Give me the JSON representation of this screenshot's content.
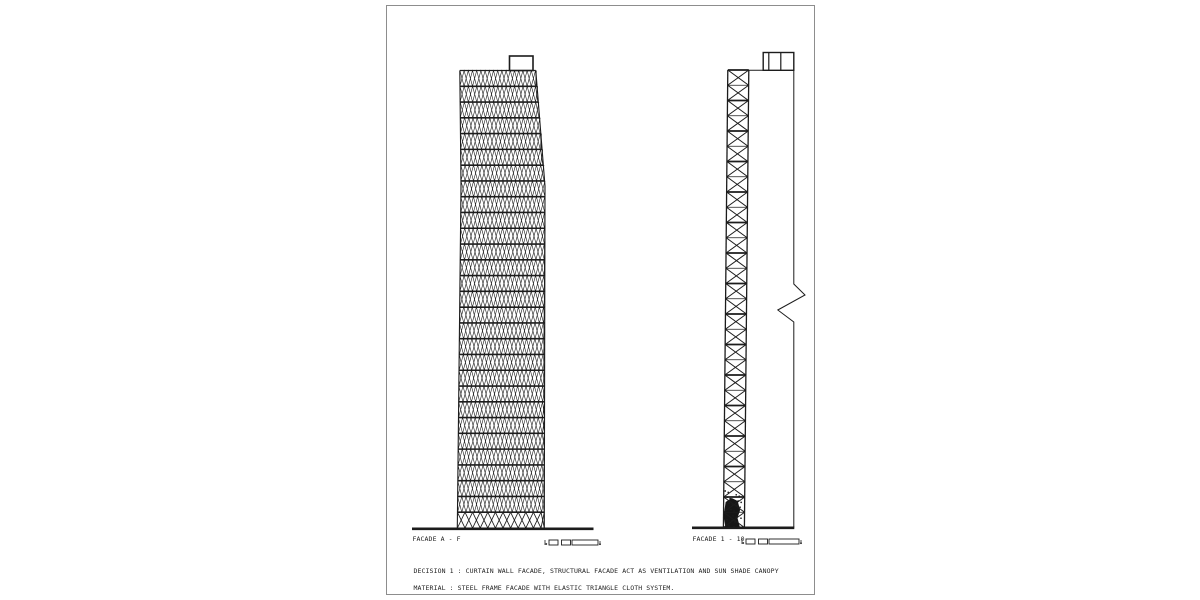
{
  "sheet": {
    "background": "#ffffff",
    "border_color": "#8d8d8d",
    "ink_color": "#1c1c1c"
  },
  "drawings": {
    "left_elevation": {
      "label": "FACADE A - F",
      "description": "front elevation with dense diagrid triangle mesh and rooftop penthouse box"
    },
    "right_elevation": {
      "label": "FACADE 1 - 10",
      "description": "narrow side elevation with X-braced truss cells, dark scribbled base, rooftop box and break-line reference"
    }
  },
  "notes": {
    "line1": "DECISION 1 : CURTAIN WALL FACADE, STRUCTURAL FACADE ACT AS VENTILATION AND SUN SHADE CANOPY",
    "line2": "MATERIAL : STEEL FRAME FACADE WITH ELASTIC TRIANGLE CLOTH SYSTEM."
  },
  "figure": {
    "ink": "#1c1c1c",
    "left_tower": {
      "top": 64.5,
      "bottom": 522,
      "bands": 29,
      "zig_period": 8.4,
      "bottom_band_period": 15.2,
      "left_edge": [
        [
          64.5,
          72.8
        ],
        [
          180,
          74.0
        ],
        [
          522,
          70.3
        ]
      ],
      "right_edge": [
        [
          64.5,
          148.8
        ],
        [
          180,
          158.0
        ],
        [
          522,
          157.3
        ]
      ],
      "roof_box": {
        "x": 122.5,
        "y": 50,
        "w": 23.5,
        "h": 14.5
      }
    },
    "left_ground": {
      "x1": 25,
      "x2": 206.5,
      "y": 522.8
    },
    "right_tower": {
      "x": 340.8,
      "y": 64,
      "w": 21,
      "h": 457.5,
      "cells": 30,
      "skew_deg": -0.55,
      "blob": {
        "y0": 428,
        "y1": 457.2
      }
    },
    "right_roofline": {
      "x1": 361.8,
      "x2": 406.8,
      "y": 64.3
    },
    "right_roof_box": {
      "x": 376.2,
      "y": 46.5,
      "w": 30.6,
      "h": 17.8,
      "dividers": [
        381.8,
        393.8
      ]
    },
    "break_line": {
      "x": 406.8,
      "top": 64.3,
      "y1": 278,
      "mid": [
        [
          418,
          289
        ],
        [
          390.8,
          304
        ],
        [
          406.8,
          316
        ]
      ],
      "bottom": 521.5
    },
    "right_ground": {
      "x1": 305,
      "x2": 407.3,
      "y": 521.8
    },
    "scale_bars": [
      {
        "x": 158,
        "y": 532,
        "seg": [
          9,
          9,
          26
        ]
      },
      {
        "x": 355,
        "y": 531,
        "seg": [
          9,
          9,
          30
        ]
      }
    ]
  }
}
